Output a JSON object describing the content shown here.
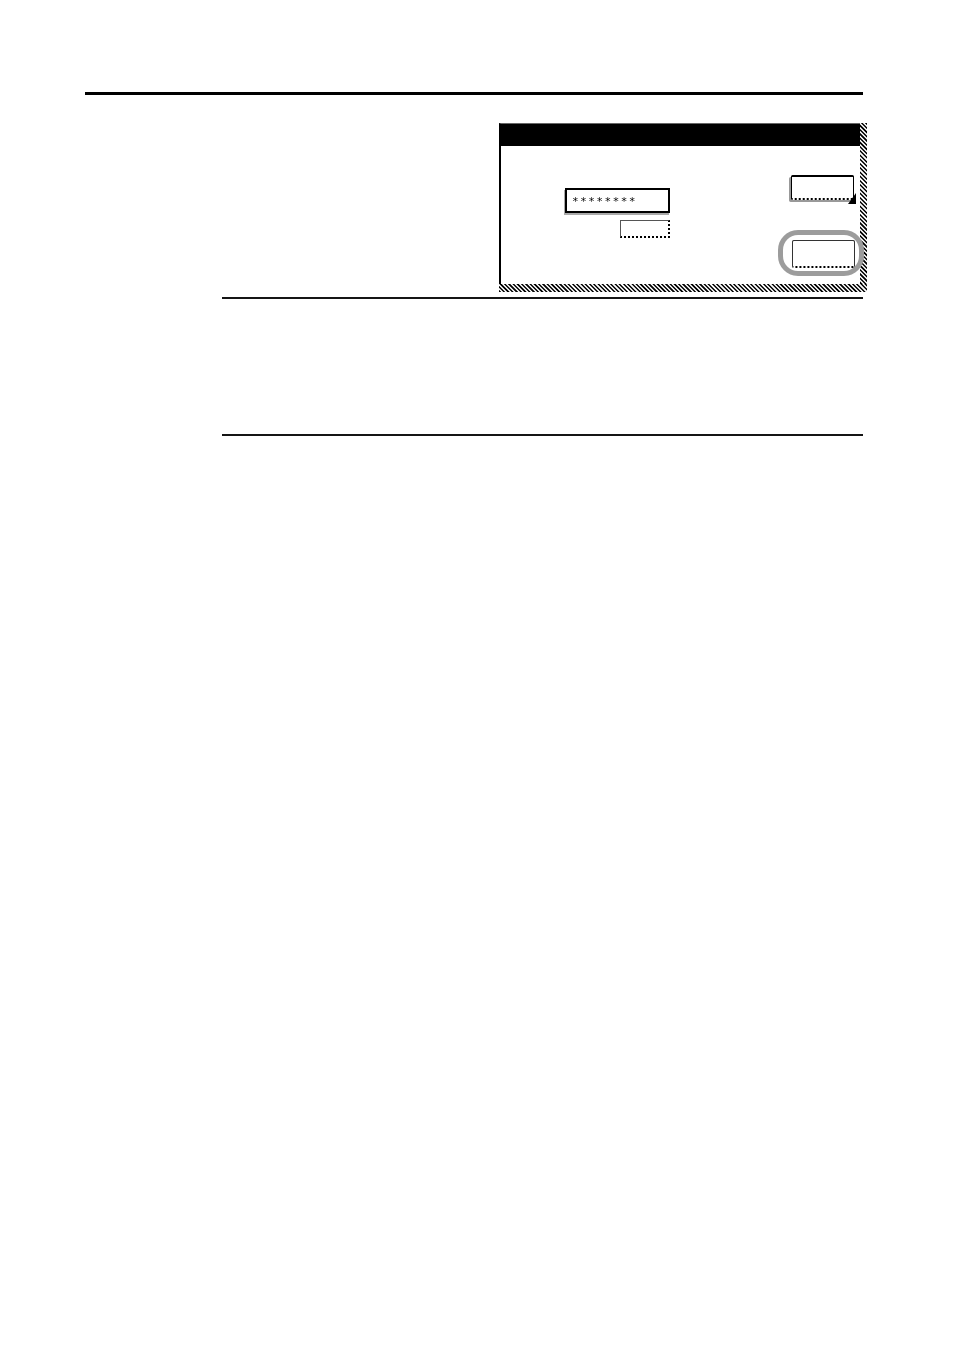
{
  "page": {
    "background_color": "#ffffff",
    "rule_color": "#000000"
  },
  "screen_panel": {
    "title_bar": {
      "label": "",
      "background_color": "#000000"
    },
    "password_field": {
      "value": "********",
      "masked": true
    },
    "entry_key": {
      "label": ""
    },
    "upper_right_key": {
      "label": "",
      "arrow_icon": "pointer-arrow-icon",
      "arrow_color": "#000000"
    },
    "lower_right_key": {
      "label": "",
      "highlighted": true,
      "highlight_color": "#9c9c9c"
    }
  }
}
